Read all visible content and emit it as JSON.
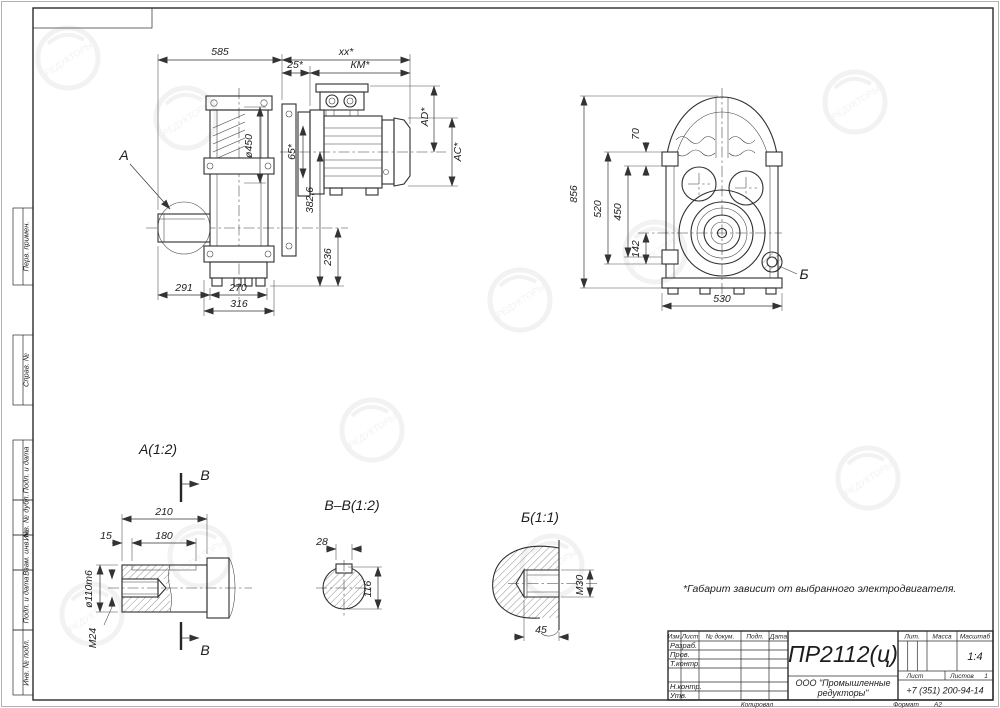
{
  "frame": {
    "left_fields": [
      "Перв. примен.",
      "Справ. №",
      "Подп. и дата",
      "Инв. № дубл.",
      "Взам. инв. №",
      "Подп. и дата",
      "Инв. № подл."
    ]
  },
  "watermark": {
    "text": "РЕДУКТОРЫ"
  },
  "note": {
    "text": "*Габарит зависит от выбранного электродвигателя."
  },
  "front_view": {
    "a_label": "А",
    "d585": "585",
    "dxx": "xx*",
    "d25": "25*",
    "dkm": "КМ*",
    "dad": "AD*",
    "dac": "AC*",
    "d450": "ø450",
    "d65": "65*",
    "d3826": "382,6",
    "d236": "236",
    "d291": "291",
    "d270": "270",
    "d316": "316"
  },
  "side_view": {
    "b_label": "Б",
    "d856": "856",
    "d70": "70",
    "d520": "520",
    "d450": "450",
    "d142": "142",
    "d530": "530"
  },
  "detail_a": {
    "title": "А(1:2)",
    "section_label": "В",
    "d210": "210",
    "d15": "15",
    "d180": "180",
    "d110": "ø110m6",
    "dm24": "М24"
  },
  "detail_bb": {
    "title": "В–В(1:2)",
    "d28": "28",
    "d116": "116"
  },
  "detail_b": {
    "title": "Б(1:1)",
    "dm30": "М30",
    "d45": "45"
  },
  "title_block": {
    "doc_number": "ПР2112(ц)",
    "company_line1": "ООО \"Промышленные",
    "company_line2": "редукторы\"",
    "phone": "+7 (351) 200-94-14",
    "col_izm": "Изм.",
    "col_list": "Лист",
    "col_dokum": "№ докум.",
    "col_podp": "Подп.",
    "col_data": "Дата",
    "row_razrab": "Разраб.",
    "row_prov": "Пров.",
    "row_tkontr": "Т.контр.",
    "row_nkontr": "Н.контр.",
    "row_utv": "Утв.",
    "lit": "Лит.",
    "massa": "Масса",
    "masshtab": "Масштаб",
    "scale_value": "1:4",
    "list_label": "Лист",
    "listov_label": "Листов",
    "listov_value": "1",
    "kopiroval": "Копировал",
    "format_label": "Формат",
    "format_value": "А2"
  }
}
